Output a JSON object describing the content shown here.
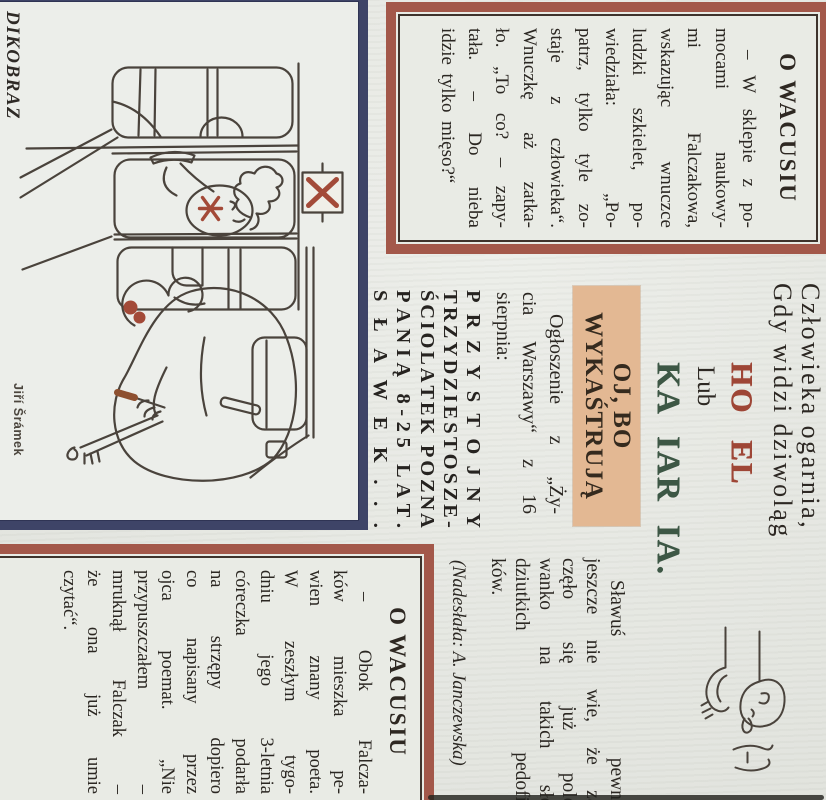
{
  "box1": {
    "title": "O WACUSIU",
    "body_lines": [
      "– W sklepie z po-",
      "mocami naukowy-",
      "mi Falczakowa,",
      "wskazując wnuczce",
      "ludzki szkielet, po-",
      "wiedziała: „Po-",
      "patrz, tylko tyle zo-",
      "staje z człowieka“.",
      "Wnuczkę aż zatka-",
      "ło. „To co? – zapy-",
      "tała. – Do nieba",
      "idzie tylko mięso?“"
    ]
  },
  "verse": {
    "line1": "Człowieka ogarnia,",
    "line2": "Gdy widzi dziwoląg",
    "neon_word1": "HO EL",
    "connector": "Lub",
    "neon_word2": "KA IAR IA."
  },
  "feature": {
    "highlight_line1": "OJ, BO",
    "highlight_line2": "WYKAŚTRUJĄ",
    "announce_lines": [
      "Ogłoszenie z „Ży-",
      "cia Warszawy“ z 16",
      "sierpnia:"
    ],
    "ad_lines": [
      "PRZYSTOJNY",
      "TRZYDZIESTOSZE-",
      "ŚCIOLATEK POZNA",
      "PANIĄ 8-25 LAT.",
      "SŁAWEK..."
    ],
    "comment_lines": [
      "Sławuś pewnie",
      "jeszcze nie wie, że za-",
      "częło się już polo-",
      "wanko na takich sło-",
      "dziutkich pedofil-",
      "ków."
    ],
    "credit": "(Nadesłała: A. Janczewska)"
  },
  "box2": {
    "title": "O WACUSIU",
    "body_lines": [
      "– Obok Falcza-",
      "ków mieszka pe-",
      "wien znany poeta.",
      "W zeszłym tygo-",
      "dniu jego 3-letnia",
      "córeczka podarła",
      "na strzępy dopiero",
      "co napisany przez",
      "ojca poemat. „Nie",
      "przypuszczałem –",
      "mruknął Falczak –",
      "że ona już umie",
      "czytać“."
    ]
  },
  "cartoon": {
    "magazine": "DIKOBRAZ",
    "artist": "Jiří Šrámek"
  },
  "colors": {
    "paper": "#e7e9e3",
    "frame_red": "#a3584a",
    "frame_navy": "#3e4467",
    "highlight_tan": "#e3b893",
    "neon_red": "#9e4636",
    "neon_green": "#3d5745",
    "ink": "#2b2722"
  }
}
